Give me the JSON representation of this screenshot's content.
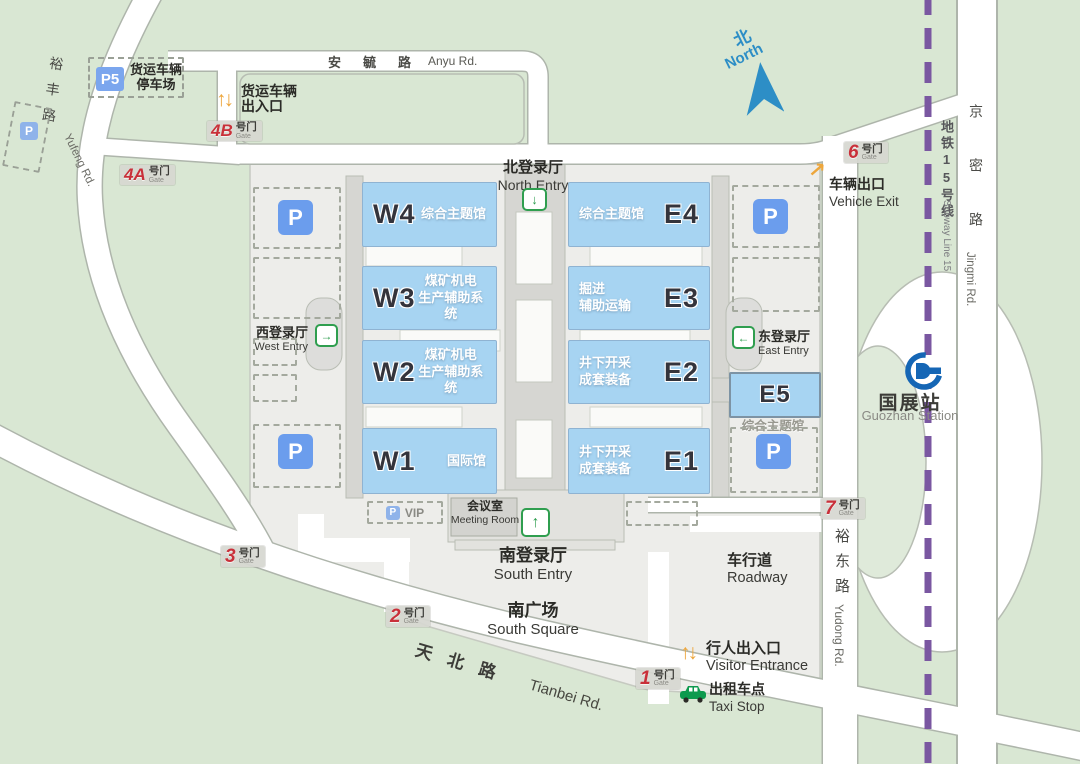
{
  "roads": {
    "anyu_zh": "安毓路",
    "anyu_en": "Anyu Rd.",
    "yufeng_zh": "裕丰路",
    "yufeng_en": "Yufeng Rd.",
    "tianbei_zh": "天北路",
    "tianbei_en": "Tianbei Rd.",
    "yudong_zh": "裕东路",
    "yudong_en": "Yudong Rd.",
    "jingmi_zh": "京密路",
    "jingmi_en": "Jingmi Rd."
  },
  "compass": {
    "zh": "北",
    "en": "North"
  },
  "subway": {
    "line_zh": "地铁15号线",
    "line_en": "Subway Line 15",
    "station_zh": "国展站",
    "station_en": "Guozhan Station"
  },
  "entries": {
    "north": {
      "zh": "北登录厅",
      "en": "North Entry"
    },
    "south": {
      "zh": "南登录厅",
      "en": "South Entry"
    },
    "west": {
      "zh": "西登录厅",
      "en": "West Entry"
    },
    "east": {
      "zh": "东登录厅",
      "en": "East Entry"
    }
  },
  "halls": {
    "w4": {
      "code": "W4",
      "l1": "综合主题馆",
      "l2": ""
    },
    "w3": {
      "code": "W3",
      "l1": "煤矿机电",
      "l2": "生产辅助系统"
    },
    "w2": {
      "code": "W2",
      "l1": "煤矿机电",
      "l2": "生产辅助系统"
    },
    "w1": {
      "code": "W1",
      "l1": "国际馆",
      "l2": ""
    },
    "e4": {
      "code": "E4",
      "l1": "综合主题馆",
      "l2": ""
    },
    "e3": {
      "code": "E3",
      "l1": "掘进",
      "l2": "辅助运输"
    },
    "e2": {
      "code": "E2",
      "l1": "井下开采",
      "l2": "成套装备"
    },
    "e1": {
      "code": "E1",
      "l1": "井下开采",
      "l2": "成套装备"
    },
    "e5": {
      "code": "E5",
      "label": "综合主题馆"
    }
  },
  "gates": {
    "suffix_zh": "号门",
    "suffix_en": "Gate",
    "g1": "1",
    "g2": "2",
    "g3": "3",
    "g4a": "4A",
    "g4b": "4B",
    "g6": "6",
    "g7": "7"
  },
  "facilities": {
    "freight_lot_badge": "P5",
    "freight_lot_l1": "货运车辆",
    "freight_lot_l2": "停车场",
    "freight_gate_l1": "货运车辆",
    "freight_gate_l2": "出入口",
    "vehicle_exit_zh": "车辆出口",
    "vehicle_exit_en": "Vehicle Exit",
    "visitor_zh": "行人出入口",
    "visitor_en": "Visitor Entrance",
    "taxi_zh": "出租车点",
    "taxi_en": "Taxi Stop",
    "roadway_zh": "车行道",
    "roadway_en": "Roadway",
    "south_square_zh": "南广场",
    "south_square_en": "South Square",
    "meeting_zh": "会议室",
    "meeting_en": "Meeting Room",
    "vip": "VIP",
    "p": "P",
    "up_arrow": "↑",
    "down_arrow": "↓",
    "right_arrow": "→",
    "left_arrow": "←",
    "ne_arrow": "↗"
  },
  "colors": {
    "bg_green": "#d9e7d3",
    "campus_gray": "#ededea",
    "hall_blue": "#a7d4f2",
    "gate_red": "#c9303a",
    "entry_green": "#2f9e4f",
    "subway_purple": "#7a57a1",
    "arrow_orange": "#eda63c",
    "north_blue": "#2d8ec6",
    "station_blue": "#1566b5",
    "parking_blue": "#6b9ded"
  }
}
